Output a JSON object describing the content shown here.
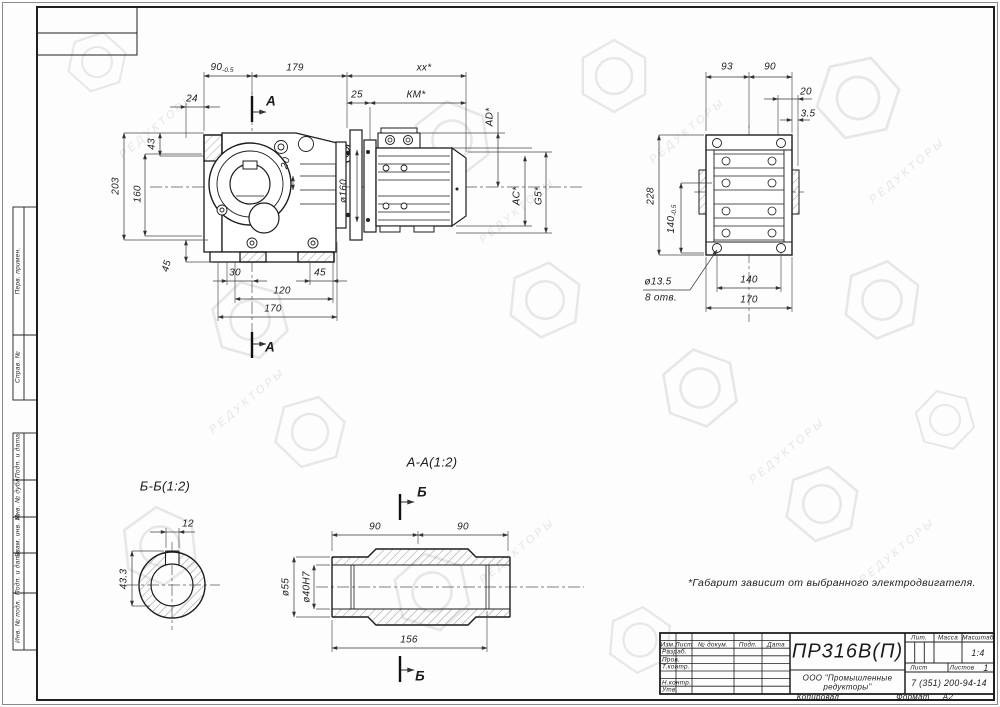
{
  "watermark": {
    "text": "РЕДУКТОРЫ"
  },
  "side_column": {
    "labels": [
      "Перв. примен.",
      "Справ. №",
      "Подп. и дата",
      "Инв. № дубл.",
      "Взам. инв. №",
      "Подп. и дата",
      "Инв. № подл."
    ]
  },
  "main_view": {
    "section_label": "А",
    "dims": {
      "width_90": {
        "value": "90",
        "tol": "-0.5"
      },
      "width_179": "179",
      "width_xx": "xx*",
      "width_24": "24",
      "height_43": "43",
      "height_203": "203",
      "height_160": "160",
      "height_45": "45",
      "bottom_30": "30",
      "bottom_45": "45",
      "bottom_120": "120",
      "bottom_170": "170",
      "motor_25": "25",
      "motor_km": "КМ*",
      "shaft_20": "20",
      "flange_d160": "ø160",
      "motor_ad": "AD*",
      "motor_ac": "AC*",
      "motor_g5": "G5*"
    }
  },
  "rear_view": {
    "dims": {
      "top_93": "93",
      "top_90": "90",
      "top_20": "20",
      "top_35": "3.5",
      "height_228": "228",
      "height_140": {
        "value": "140",
        "tol": "-0.5"
      },
      "holes_d": "ø13.5",
      "holes_n": "8 отв.",
      "bottom_140": "140",
      "bottom_170": "170"
    }
  },
  "section_bb": {
    "title": "Б-Б(1:2)",
    "dims": {
      "key_12": "12",
      "depth_433": "43.3"
    }
  },
  "section_aa": {
    "title": "А-А(1:2)",
    "view_label": "Б",
    "dims": {
      "left_90": "90",
      "right_90": "90",
      "length_156": "156",
      "d55": "ø55",
      "d40": "ø40H7"
    }
  },
  "note": "*Габарит зависит от выбранного электродвигателя.",
  "title_block": {
    "headers": {
      "izm": "Изм.",
      "list": "Лист",
      "doc": "№ докум.",
      "sign": "Подп.",
      "date": "Дата"
    },
    "rows": [
      "Разраб.",
      "Пров.",
      "Т.контр.",
      "Н.контр.",
      "Утв."
    ],
    "part_number": "ПР316В(П)",
    "company_line1": "ООО \"Промышленные",
    "company_line2": "редукторы\"",
    "lit": "Лит.",
    "mass": "Масса",
    "scale_label": "Масштаб",
    "scale": "1:4",
    "sheet_label": "Лист",
    "sheets_label": "Листов",
    "sheets": "1",
    "phone": "7 (351) 200-94-14",
    "copied": "Копировал",
    "format_label": "Формат",
    "format": "А2"
  }
}
